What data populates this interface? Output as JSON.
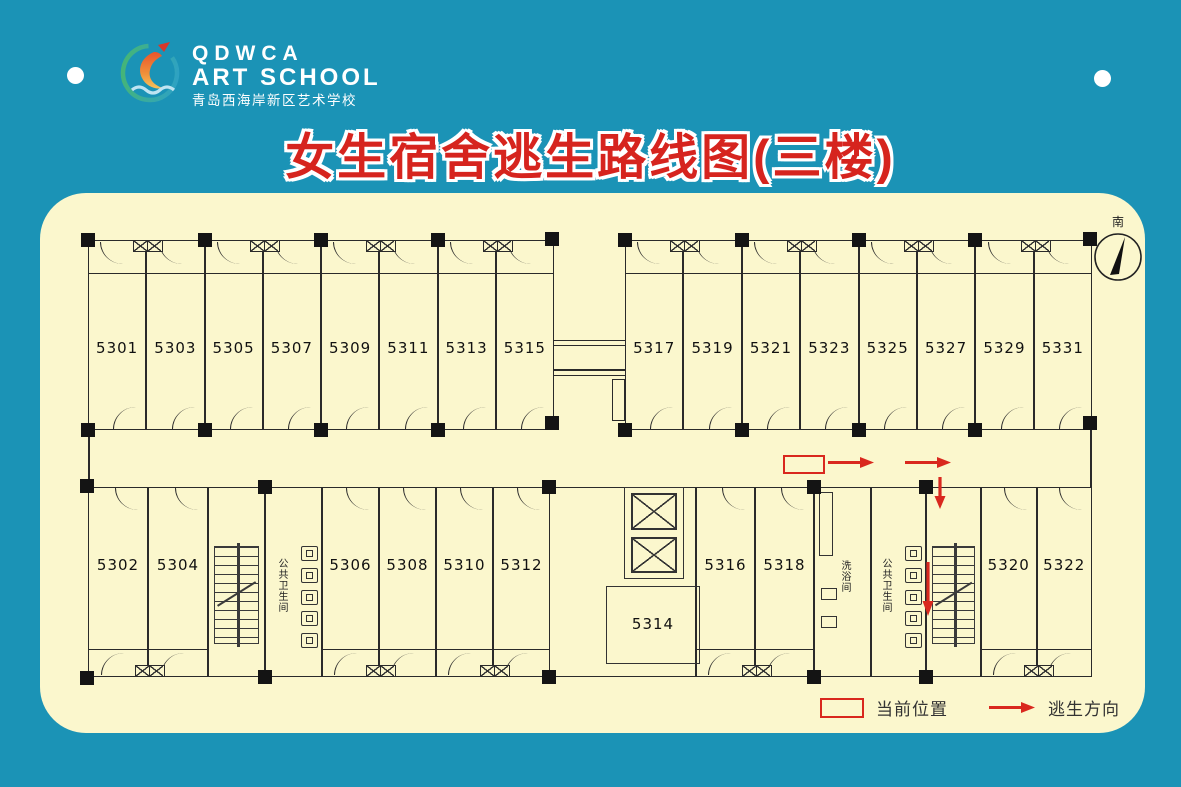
{
  "header": {
    "logo_en1": "QDWCA",
    "logo_en2": "ART SCHOOL",
    "logo_cn": "青岛西海岸新区艺术学校"
  },
  "title": "女生宿舍逃生路线图(三楼)",
  "compass_label": "南",
  "floor_plan": {
    "top_left_rooms": [
      "5301",
      "5303",
      "5305",
      "5307",
      "5309",
      "5311",
      "5313",
      "5315"
    ],
    "top_right_rooms": [
      "5317",
      "5319",
      "5321",
      "5323",
      "5325",
      "5327",
      "5329",
      "5331"
    ],
    "bottom_left_rooms": [
      "5302",
      "5304"
    ],
    "bottom_mid_rooms": [
      "5306",
      "5308",
      "5310",
      "5312"
    ],
    "elevator_room": "5314",
    "bottom_mid2_rooms": [
      "5316",
      "5318"
    ],
    "bottom_right_rooms": [
      "5320",
      "5322"
    ],
    "shower_label": "洗浴间",
    "toilet_label": "公共卫生间"
  },
  "legend": {
    "current_position": "当前位置",
    "escape_direction": "逃生方向"
  },
  "colors": {
    "background": "#1b93b6",
    "panel": "#fbf7cd",
    "title_red": "#d6241e",
    "arrow_red": "#d9281e",
    "line": "#2a2a2a"
  }
}
